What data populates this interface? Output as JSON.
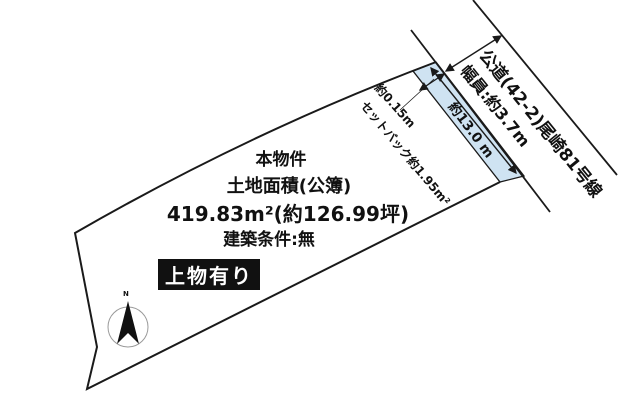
{
  "diagram": {
    "property_label": "本物件",
    "area_title": "土地面積(公簿)",
    "area_value": "419.83m²(約126.99坪)",
    "building_condition": "建築条件:無",
    "structure_note": "上物有り",
    "road_name": "公道(42-2)尾崎81号線",
    "road_width": "幅員:約3.7m",
    "frontage_length": "約13.0 m",
    "setback_width": "約0.15m",
    "setback_area": "セットバック約1.95m²",
    "compass_north": "N"
  },
  "colors": {
    "setback_fill": "#cfe3f2",
    "line": "#1a1a1a",
    "badge_bg": "#111111",
    "badge_text": "#ffffff"
  }
}
